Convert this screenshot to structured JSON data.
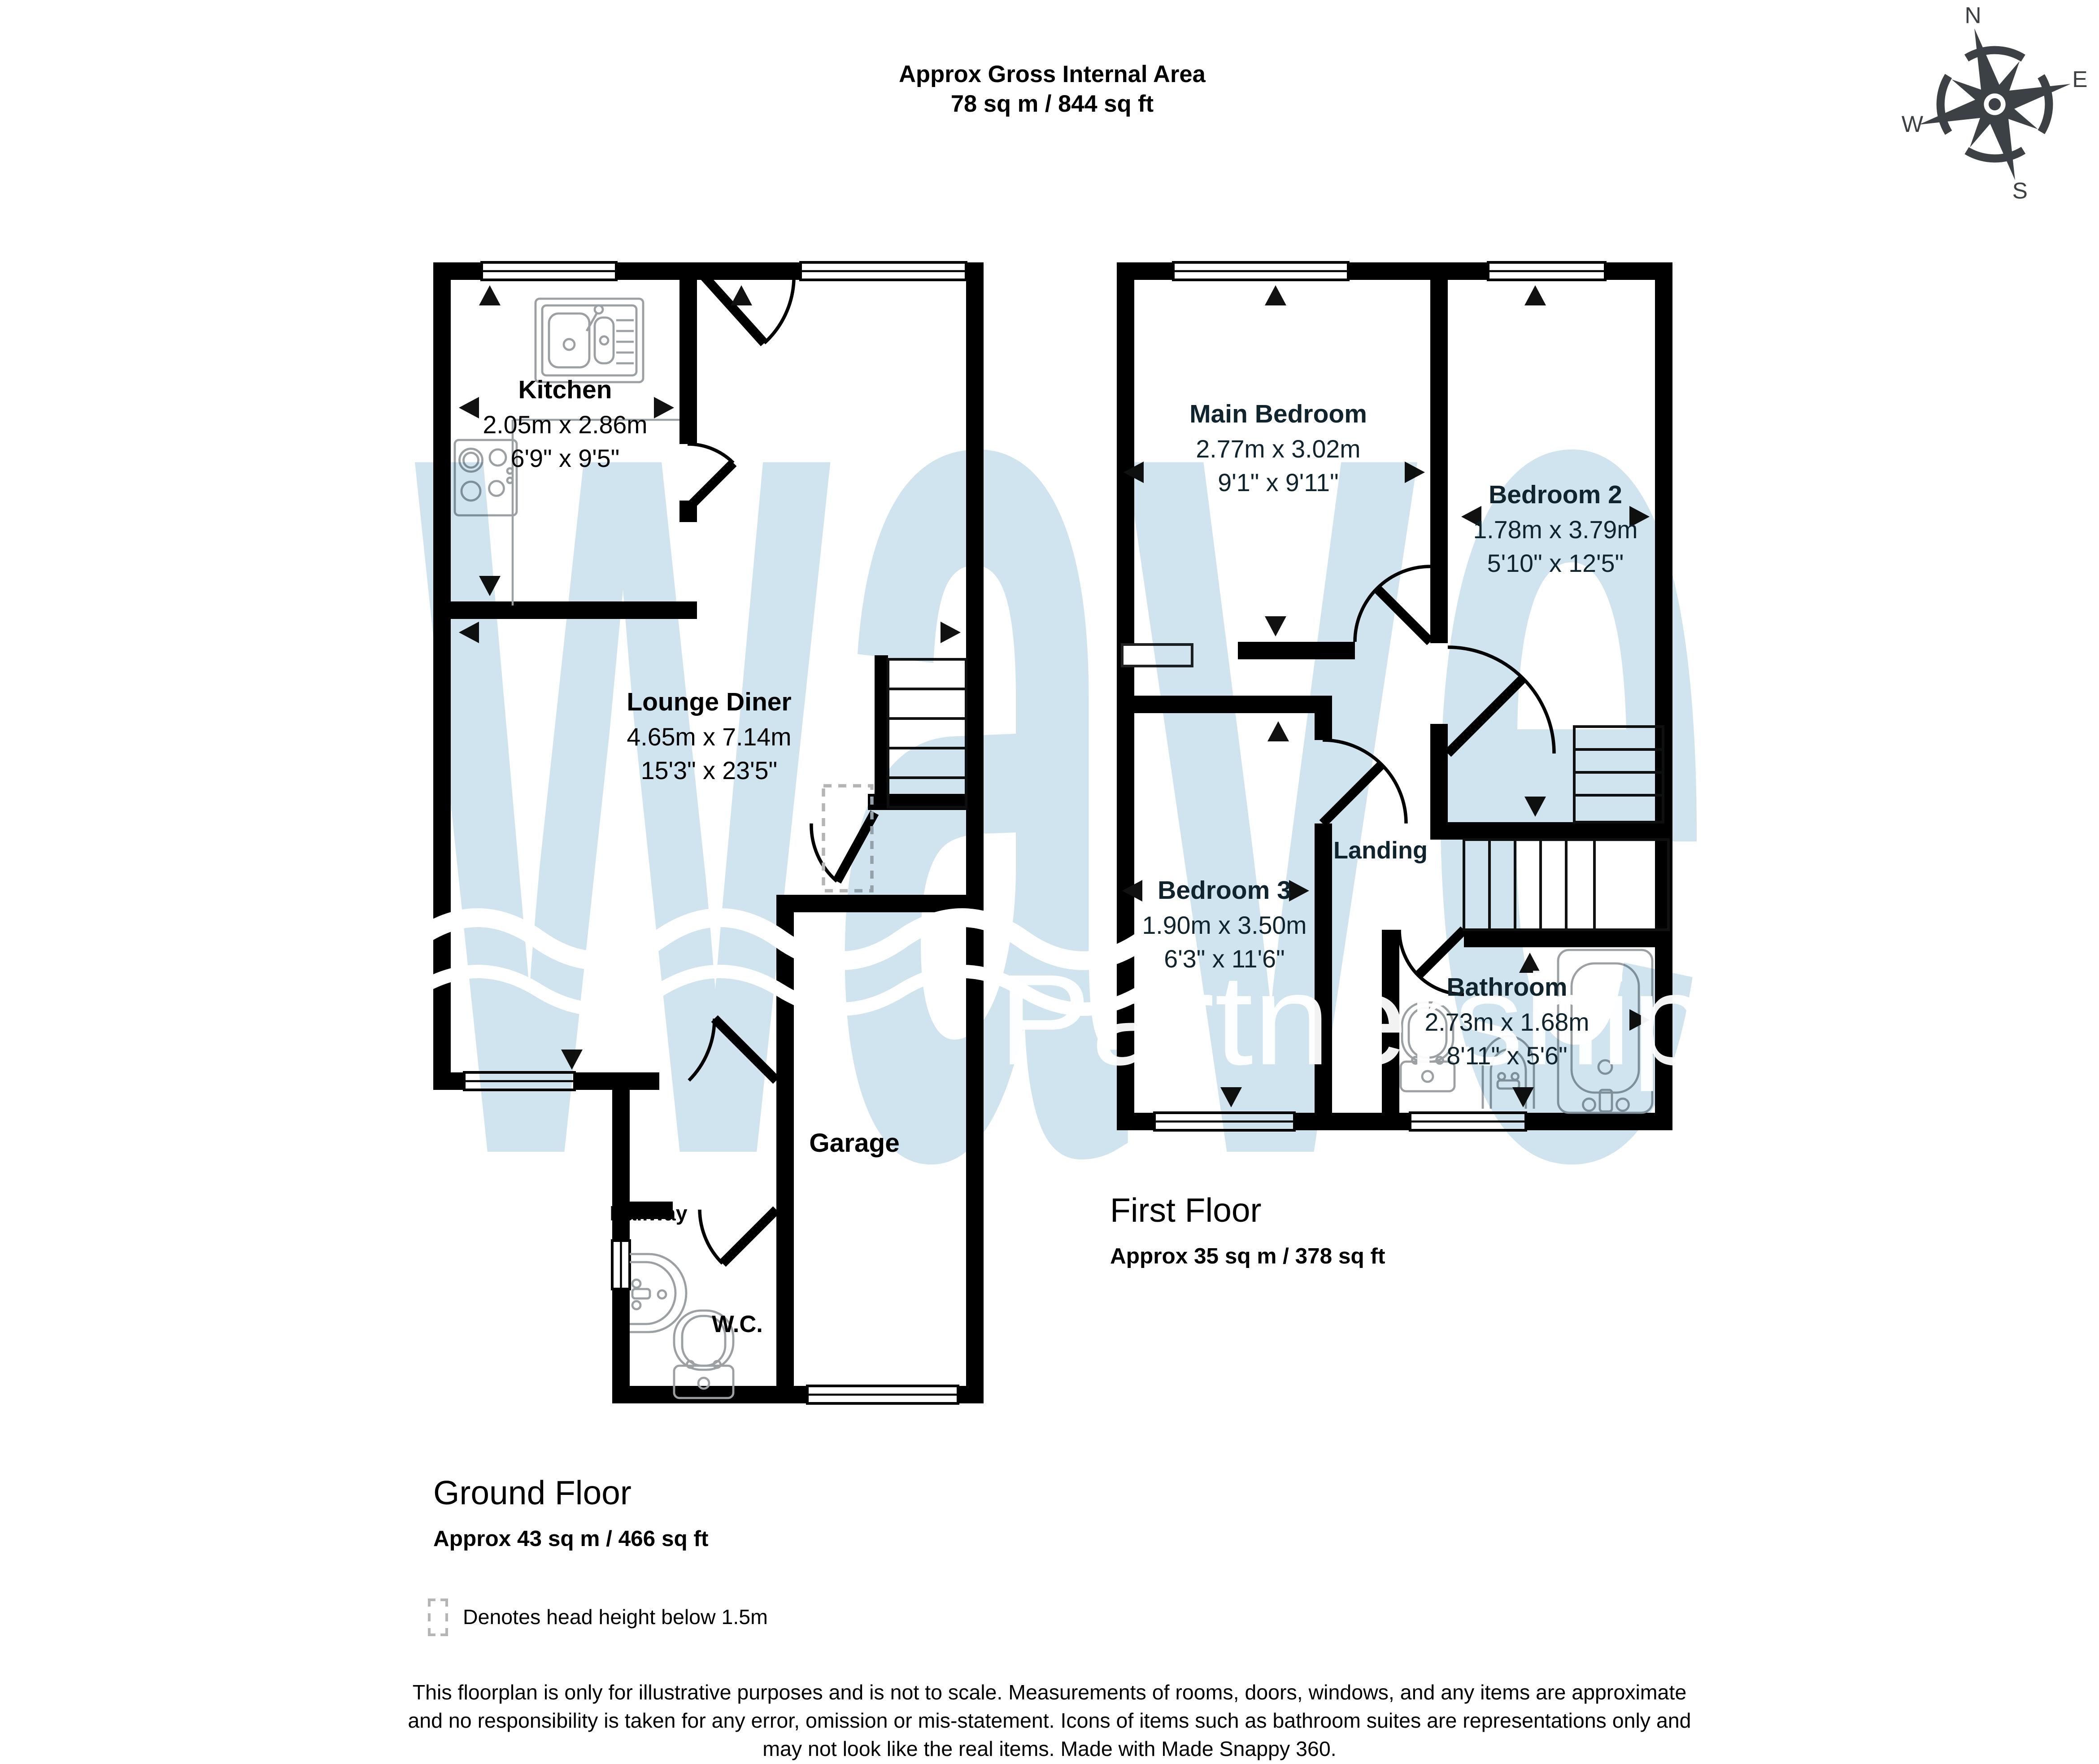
{
  "header": {
    "line1": "Approx Gross Internal Area",
    "line2": "78 sq m / 844 sq ft"
  },
  "compass": {
    "n": "N",
    "e": "E",
    "s": "S",
    "w": "W"
  },
  "watermark": {
    "word": "wave",
    "subword": "Partnership",
    "blue": "#cfe4ee",
    "white": "#ffffff"
  },
  "ground_floor": {
    "title": "Ground Floor",
    "area": "Approx 43 sq m / 466 sq ft",
    "rooms": {
      "kitchen": {
        "name": "Kitchen",
        "metric": "2.05m x 2.86m",
        "imperial": "6'9\" x 9'5\""
      },
      "lounge": {
        "name": "Lounge Diner",
        "metric": "4.65m x 7.14m",
        "imperial": "15'3\" x 23'5\""
      },
      "hallway": {
        "name": "Hallway"
      },
      "wc": {
        "name": "W.C."
      },
      "garage": {
        "name": "Garage"
      }
    }
  },
  "first_floor": {
    "title": "First Floor",
    "area": "Approx 35 sq m / 378 sq ft",
    "rooms": {
      "main_bedroom": {
        "name": "Main Bedroom",
        "metric": "2.77m x 3.02m",
        "imperial": "9'1\" x 9'11\""
      },
      "bedroom2": {
        "name": "Bedroom 2",
        "metric": "1.78m x 3.79m",
        "imperial": "5'10\" x 12'5\""
      },
      "bedroom3": {
        "name": "Bedroom 3",
        "metric": "1.90m x 3.50m",
        "imperial": "6'3\" x 11'6\""
      },
      "landing": {
        "name": "Landing"
      },
      "bathroom": {
        "name": "Bathroom",
        "metric": "2.73m x 1.68m",
        "imperial": "8'11\" x 5'6\""
      }
    }
  },
  "legend": {
    "note": "Denotes head height below 1.5m"
  },
  "disclaimer": {
    "line1": "This floorplan is only for illustrative purposes and is not to scale. Measurements of rooms, doors, windows, and any items are approximate",
    "line2": "and no responsibility is taken for any error, omission or mis-statement. Icons of items such as bathroom suites are representations only and",
    "line3": "may not look like the real items. Made with Made Snappy 360."
  },
  "colors": {
    "wall": "#000000",
    "first_floor_text": "#10242e",
    "fixture_line": "#9aa0a3",
    "dashed_legend": "#b5b5b5",
    "compass": "#3c4146",
    "watermark_blue": "#cfe4ee"
  },
  "icons": {
    "compass-rose-icon": "8-point compass rose with N/E/S/W letters",
    "kitchen-sink-icon": "double-bowl sink with drainer and tap",
    "hob-icon": "4-ring cooktop",
    "toilet-icon": "toilet with cistern",
    "basin-icon": "wash hand basin",
    "bathtub-icon": "bathtub with taps",
    "stairs-icon": "staircase treads",
    "window-icon": "double-line window in wall",
    "door-arc-icon": "door leaf with swing arc",
    "dimension-arrow-icon": "measurement arrowhead",
    "head-height-box-icon": "dashed box: head height below 1.5m"
  }
}
